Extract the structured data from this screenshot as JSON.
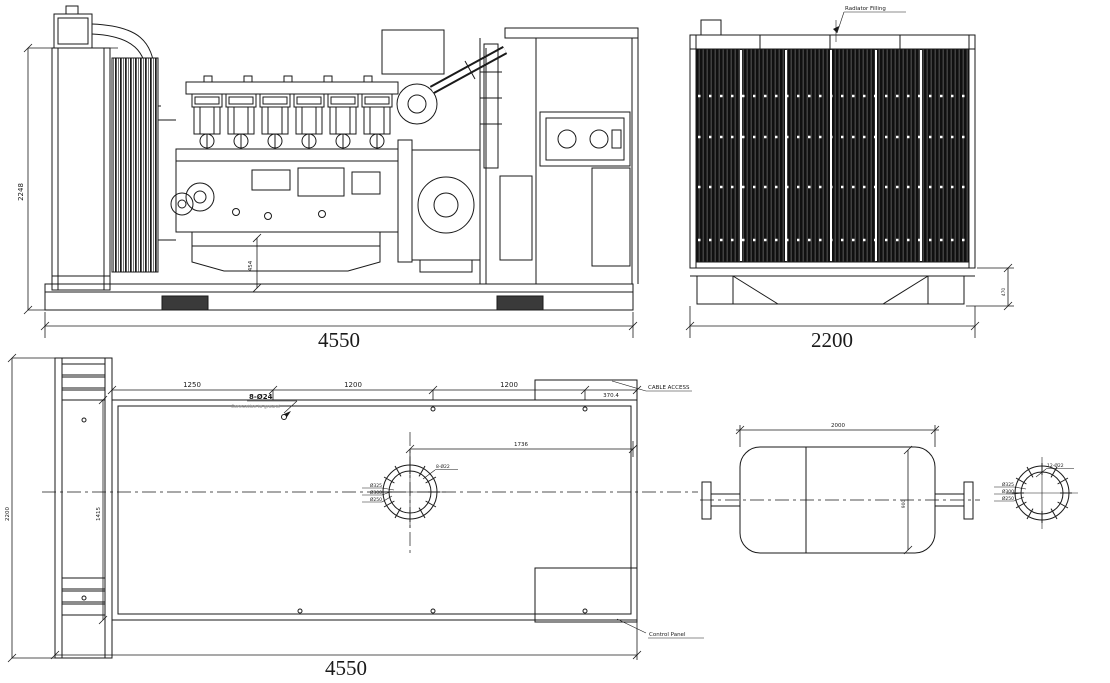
{
  "sheet": {
    "background": "#ffffff",
    "line_color": "#1a1a1a"
  },
  "views": {
    "side": {
      "overall_width_dim": "4550",
      "overall_height_dim": "2248",
      "detail_height_dim": "454"
    },
    "front": {
      "overall_width_dim": "2200",
      "radiator_filling_label": "Radiator Filling",
      "skid_height_dim": "470"
    },
    "plan": {
      "overall_width_dim": "4550",
      "overall_depth_dim": "2200",
      "inner_depth_dim": "1415",
      "segment_dims": [
        "1250",
        "1200",
        "1200",
        "370.4"
      ],
      "exhaust_offset_dim": "1736",
      "cable_access_label": "CABLE ACCESS",
      "control_panel_label": "Control Panel",
      "anchor_bolt_callout": "8-Ø24",
      "ground_note": "Connection to ground",
      "flange": {
        "bolt_callout": "8-Ø22",
        "dia_labels": [
          "Ø325",
          "Ø300",
          "Ø250"
        ]
      }
    },
    "tank": {
      "width_dim": "2000",
      "depth_dim": "900",
      "flange": {
        "bolt_callout": "12-Ø22",
        "dia_labels": [
          "Ø325",
          "Ø300",
          "Ø250"
        ]
      }
    }
  }
}
